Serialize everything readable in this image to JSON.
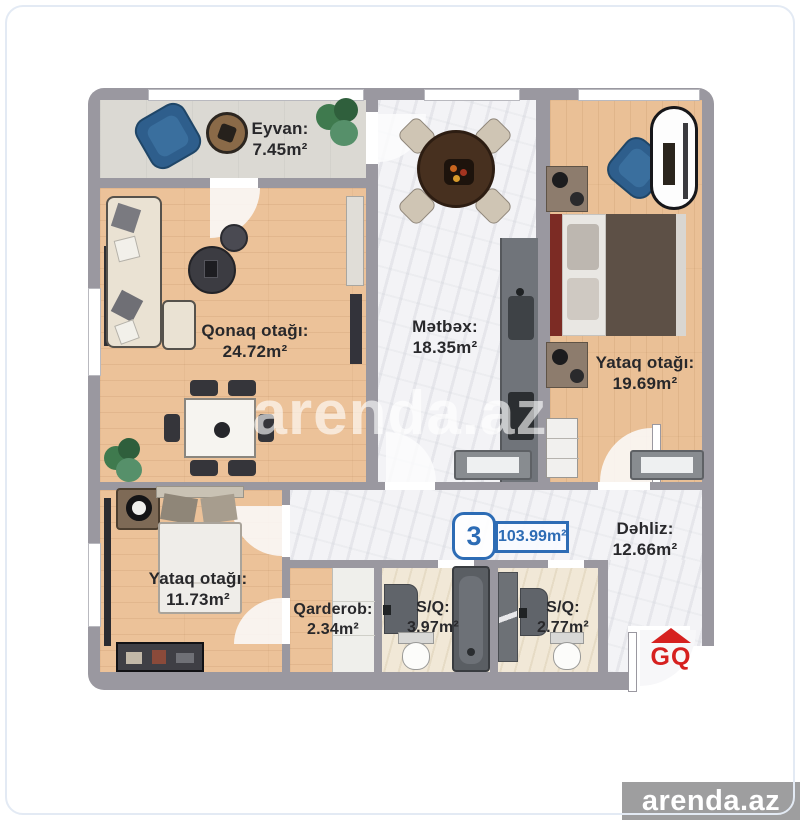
{
  "branding": {
    "watermark": "arenda.az",
    "footer_badge": "arenda.az",
    "builder_logo": "GQ"
  },
  "badge": {
    "rooms_count": "3",
    "total_area": "103.99m²"
  },
  "rooms": [
    {
      "id": "eyvan",
      "label": "Eyvan:",
      "area": "7.45m²"
    },
    {
      "id": "qonaq",
      "label": "Qonaq otağı:",
      "area": "24.72m²"
    },
    {
      "id": "metbex",
      "label": "Mətbəx:",
      "area": "18.35m²"
    },
    {
      "id": "yataq-1",
      "label": "Yataq otağı:",
      "area": "19.69m²"
    },
    {
      "id": "dehliz",
      "label": "Dəhliz:",
      "area": "12.66m²"
    },
    {
      "id": "yataq-2",
      "label": "Yataq otağı:",
      "area": "11.73m²"
    },
    {
      "id": "qarderob",
      "label": "Qarderob:",
      "area": "2.34m²"
    },
    {
      "id": "sq-1",
      "label": "S/Q:",
      "area": "3.97m²"
    },
    {
      "id": "sq-2",
      "label": "S/Q:",
      "area": "2.77m²"
    }
  ],
  "colors": {
    "accent_blue": "#2d6cb5",
    "logo_red": "#d6201f",
    "wall_gray": "#9a98a0",
    "wood_floor": "#ecc299",
    "marble_floor": "#f3f3f6",
    "footer_gray": "#9e9e9f"
  }
}
